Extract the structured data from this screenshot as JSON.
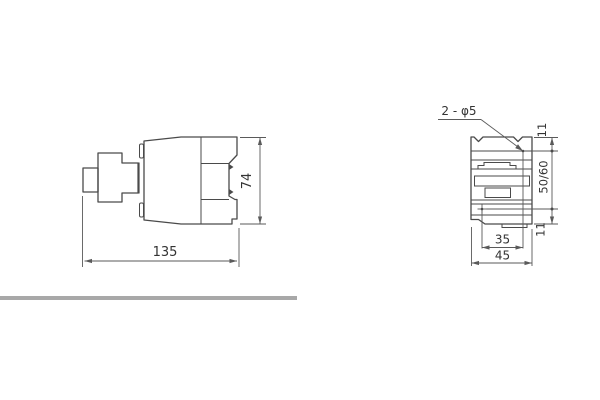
{
  "page": {
    "background": "#ffffff",
    "description": "Technical dimensional drawing of a contactor: side view and mounting-face view"
  },
  "drawing": {
    "line_color": "#4a4a4a",
    "dim_color": "#5a5a5a",
    "text_color": "#333333",
    "divider_color": "#a8a8a8",
    "side_view": {
      "width_label": "135",
      "height_label": "74"
    },
    "front_view": {
      "holes_label": "2 - φ5",
      "top_offset_label": "11",
      "vertical_spacing_label": "50/60",
      "bottom_offset_label": "11",
      "horizontal_spacing_label": "35",
      "width_label": "45"
    }
  }
}
